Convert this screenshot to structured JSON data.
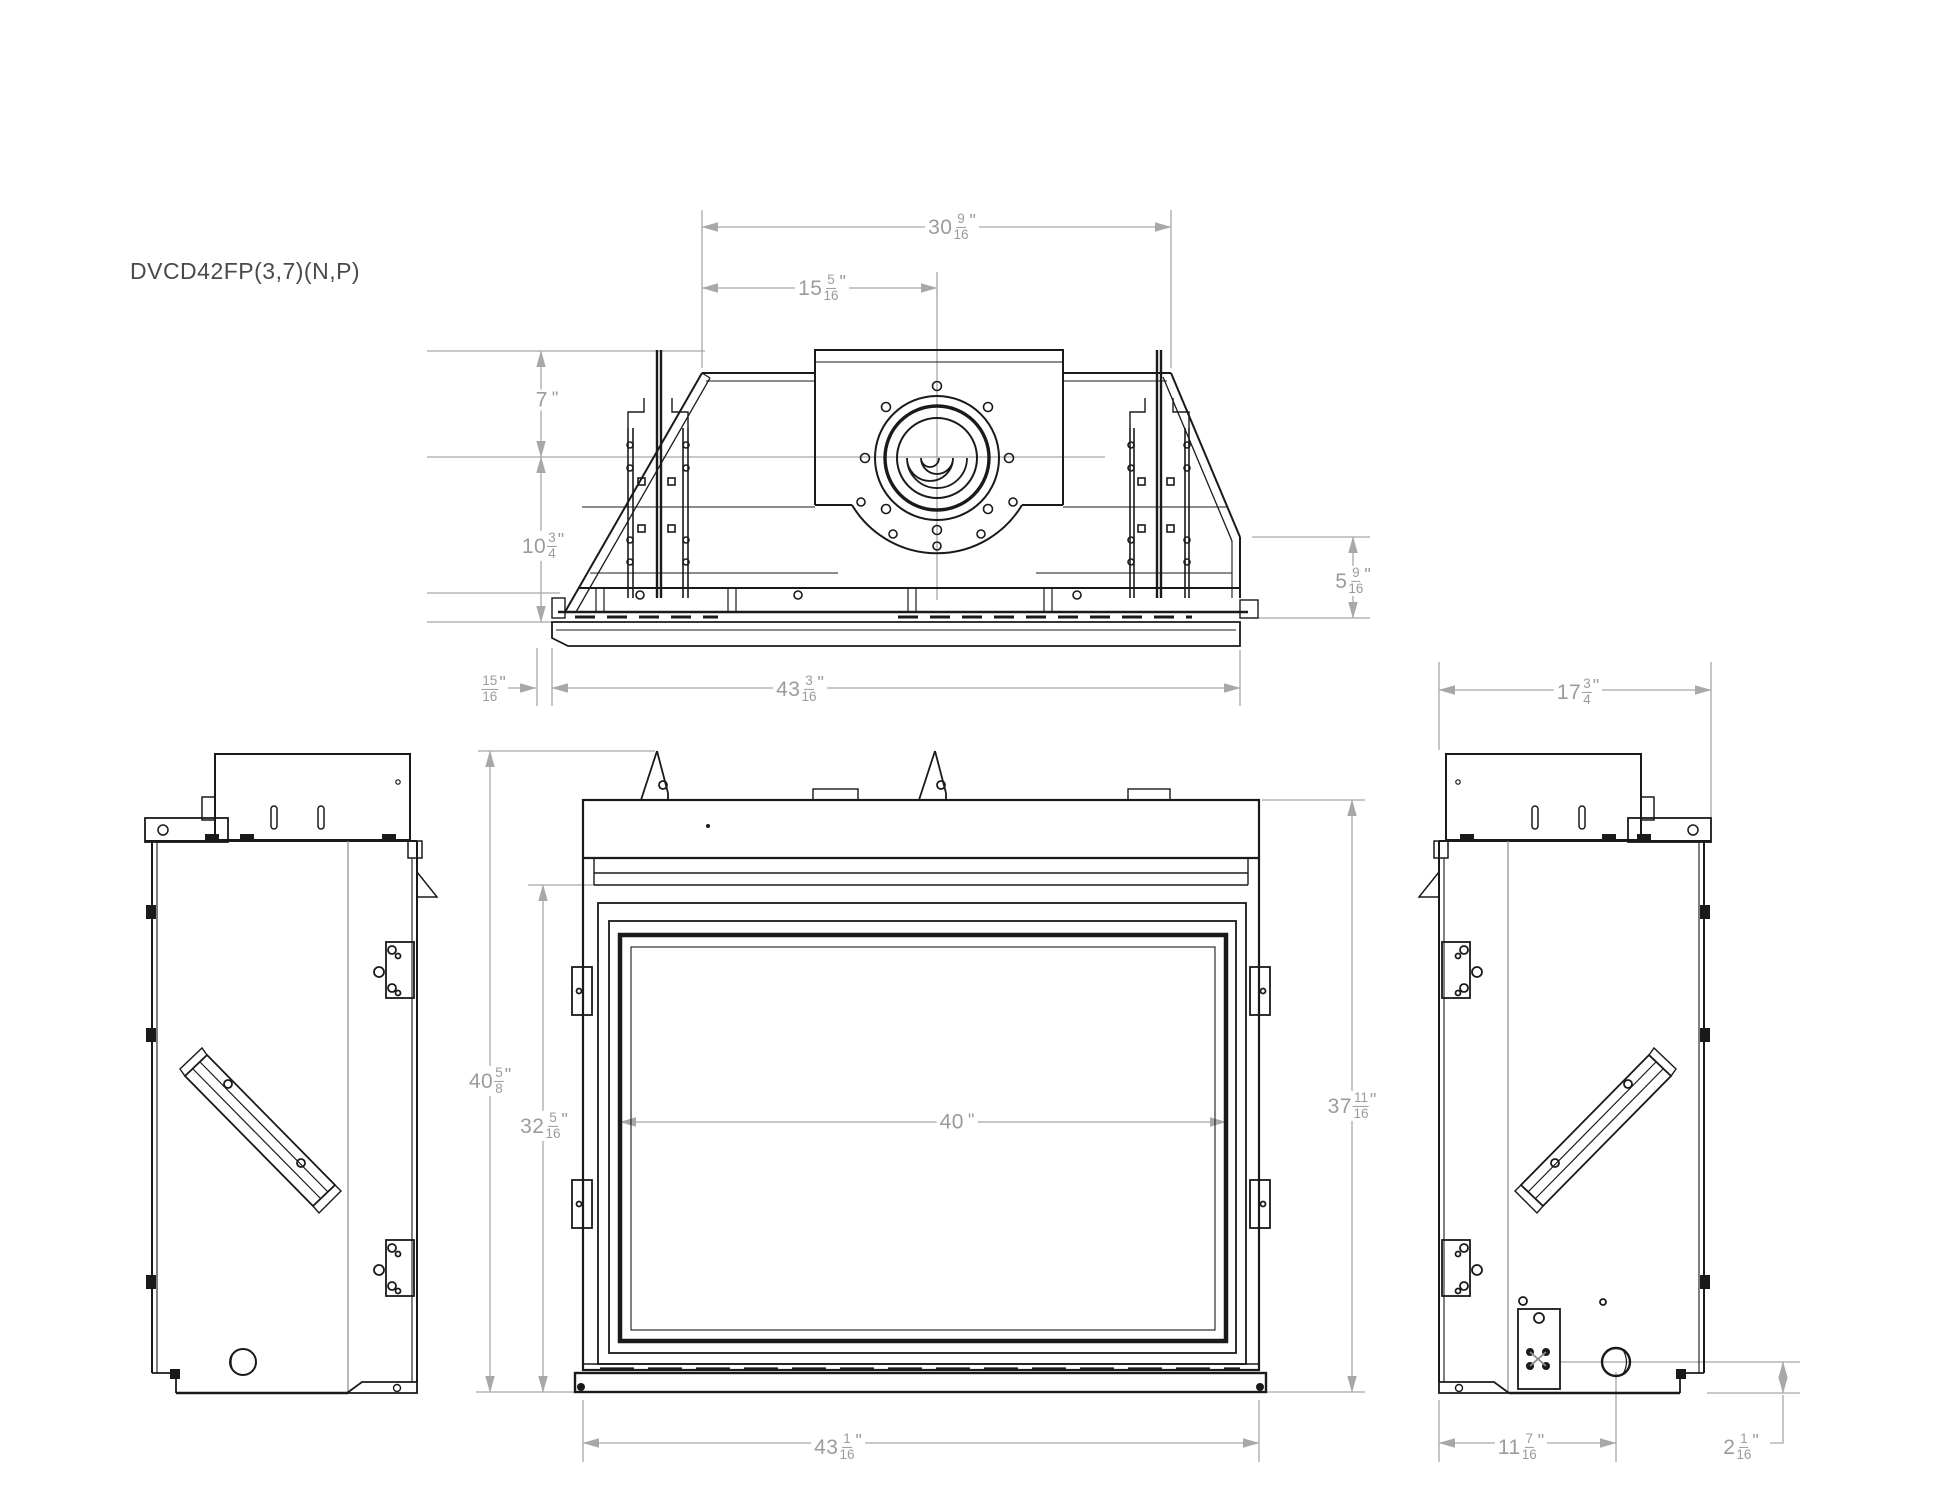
{
  "title": "DVCD42FP(3,7)(N,P)",
  "colors": {
    "line": "#1a1a1a",
    "dim_line": "#a8a8a8",
    "dim_text": "#9b9b9b",
    "title_text": "#4a4a4a",
    "background": "#ffffff"
  },
  "views": {
    "top": "top-view",
    "front": "front-view",
    "left": "left-side-view",
    "right": "right-side-view"
  },
  "dimensions": {
    "top_width_back": {
      "w": "30",
      "n": "9",
      "d": "16",
      "u": "\""
    },
    "top_flue_offset": {
      "w": "15",
      "n": "5",
      "d": "16",
      "u": "\""
    },
    "flue_to_back": {
      "w": "7",
      "n": "",
      "d": "",
      "u": "\""
    },
    "flue_to_front": {
      "w": "10",
      "n": "3",
      "d": "4",
      "u": "\""
    },
    "right_step_height": {
      "w": "5",
      "n": "9",
      "d": "16",
      "u": "\""
    },
    "front_lip": {
      "w": "",
      "n": "15",
      "d": "16",
      "u": "\""
    },
    "top_width_front": {
      "w": "43",
      "n": "3",
      "d": "16",
      "u": "\""
    },
    "front_height_total": {
      "w": "40",
      "n": "5",
      "d": "8",
      "u": "\""
    },
    "front_opening_h": {
      "w": "32",
      "n": "5",
      "d": "16",
      "u": "\""
    },
    "glass_width": {
      "w": "40",
      "n": "",
      "d": "",
      "u": "\""
    },
    "front_body_height": {
      "w": "37",
      "n": "11",
      "d": "16",
      "u": "\""
    },
    "front_width": {
      "w": "43",
      "n": "1",
      "d": "16",
      "u": "\""
    },
    "side_depth": {
      "w": "17",
      "n": "3",
      "d": "4",
      "u": "\""
    },
    "gas_hole_from_back": {
      "w": "11",
      "n": "7",
      "d": "16",
      "u": "\""
    },
    "gas_hole_height": {
      "w": "2",
      "n": "1",
      "d": "16",
      "u": "\""
    }
  }
}
